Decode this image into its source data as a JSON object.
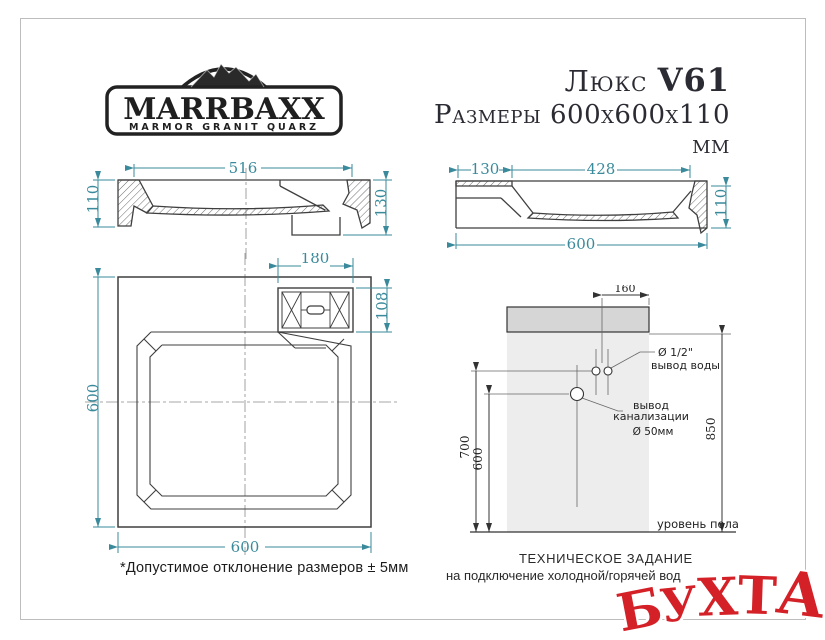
{
  "brand": {
    "name": "MARRBAXX",
    "tagline": "MARMOR GRANIT QUARZ"
  },
  "title": {
    "model_name": "Люкс",
    "model_code": "V61",
    "dimensions_label": "Размеры 600х600х110 мм"
  },
  "colors": {
    "dimension_teal": "#3a8a9b",
    "drawing_line": "#3f3f3f",
    "sink_gray": "#d6d6d6",
    "panel_gray": "#ededed",
    "watermark_red": "#d42127",
    "frame_gray": "#bdbdbd"
  },
  "views": {
    "front_section": {
      "dims": {
        "width_top": "516",
        "height_left": "110",
        "height_right": "130"
      }
    },
    "side_section": {
      "dims": {
        "ledge_width": "130",
        "bowl_width": "428",
        "total_width": "600",
        "height_right": "110"
      }
    },
    "top_view": {
      "dims": {
        "drain_width": "180",
        "drain_height": "108",
        "height_left": "600",
        "width_bottom": "600"
      }
    },
    "installation": {
      "dims": {
        "faucet_offset": "160",
        "water_height": "700",
        "drain_height": "600",
        "rim_height": "850"
      },
      "labels": {
        "water_dia": "Ø 1/2\"",
        "water_out": "вывод воды",
        "sewer_line1": "вывод",
        "sewer_line2": "канализации",
        "sewer_dia": "Ø 50мм",
        "floor": "уровень пола"
      }
    }
  },
  "notes": {
    "tolerance": "*Допустимое отклонение размеров ± 5мм",
    "tech_title": "ТЕХНИЧЕСКОЕ ЗАДАНИЕ",
    "tech_subtitle": "на подключение холодной/горячей вод",
    "watermark": "БУХТА"
  }
}
